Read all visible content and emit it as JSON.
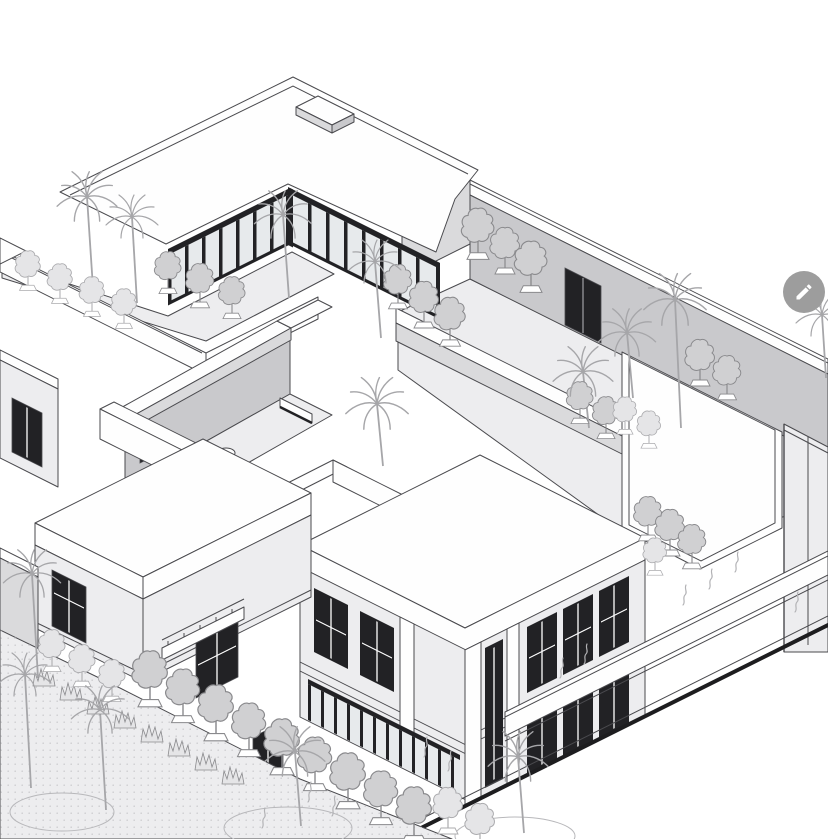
{
  "scene": {
    "description": "Monochrome axonometric architectural illustration of a modern flat-roofed villa complex with a rooftop terrace, L-shaped curtain-wall glazing, sectional cutaway rooms, palm trees, garden hedgerows and a site boundary line",
    "projection": "axonometric",
    "style": "black-and-white line drawing",
    "background": "#ffffff",
    "features": [
      "flat-roofed building masses with parapet double lines",
      "rooftop terrace with shrubs and dark double door",
      "floor-to-ceiling curtain-wall glazing with dark mullions",
      "palm trees with long trunks",
      "scalloped garden shrubs in rows",
      "sectional cutaway rooms",
      "two-story facade with dark window bays",
      "heavy diagonal site boundary line",
      "plant squiggle symbols on ground"
    ]
  },
  "palette": {
    "background": "#ffffff",
    "outline": "#4a4a4e",
    "outline_heavy": "#1d1d1f",
    "face_white": "#fefefe",
    "face_light": "#ededef",
    "face_mid": "#dadadc",
    "face_shadow": "#c9c9cc",
    "glazing_dark": "#222225",
    "glass": "#e7eaec",
    "foliage_fill": "#d0d0d2",
    "foliage_outline": "#8a8a8d",
    "foliage_light_fill": "#e5e5e7",
    "foliage_light_outline": "#ababae",
    "palm_stroke": "#a6a6a9",
    "squiggle_stroke": "#b2b2b5",
    "ground_dot": "#cdcdd0",
    "fab_background": "#9d9d9d",
    "fab_icon": "#ffffff"
  },
  "edit_button": {
    "action": "edit",
    "icon": "pencil-icon",
    "background": "#9d9d9d",
    "icon_color": "#ffffff"
  }
}
